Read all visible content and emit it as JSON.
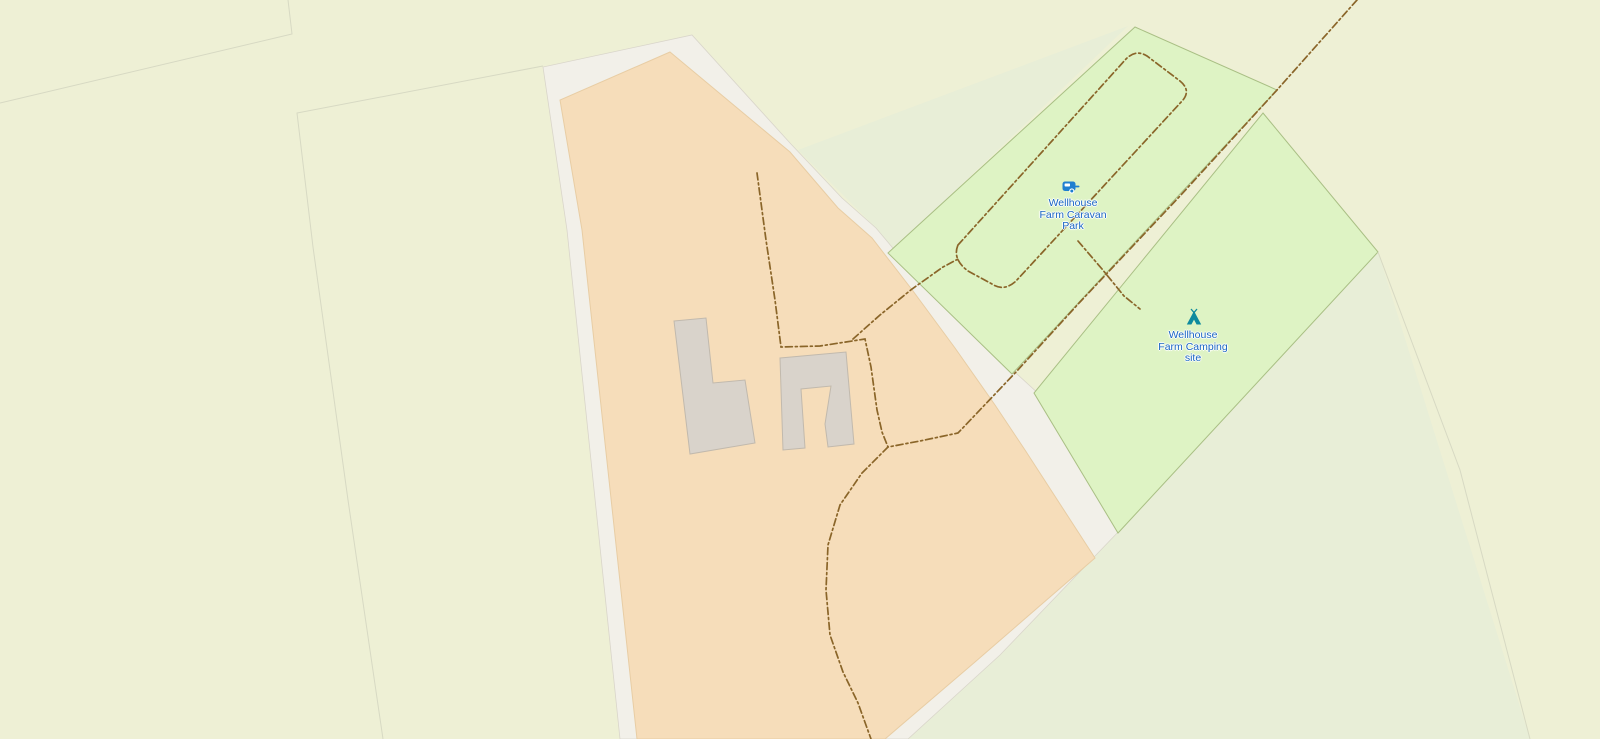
{
  "colors": {
    "farmland": "#eef0d5",
    "land_white": "#f2f0e9",
    "land_border": "#d9d5ca",
    "farmyard": "#f6ddba",
    "farmyard_border": "#e8cda4",
    "campsite_green": "#def3c4",
    "green_border": "#a9bf84",
    "pale_field": "#e8eed7",
    "building": "#d9d3cb",
    "building_border": "#c1b9ad",
    "track_brown": "#8a6529",
    "field_line": "#d7d9c3",
    "label_blue": "#1a65c4",
    "caravan_icon_blue": "#1f7fd0",
    "tent_icon_teal": "#0e8a9e"
  },
  "pois": [
    {
      "id": "caravan-park",
      "icon": "caravan-icon",
      "label_lines": [
        "Wellhouse",
        "Farm Caravan",
        "Park"
      ]
    },
    {
      "id": "camping-site",
      "icon": "tent-icon",
      "label_lines": [
        "Wellhouse",
        "Farm Camping",
        "site"
      ]
    }
  ]
}
